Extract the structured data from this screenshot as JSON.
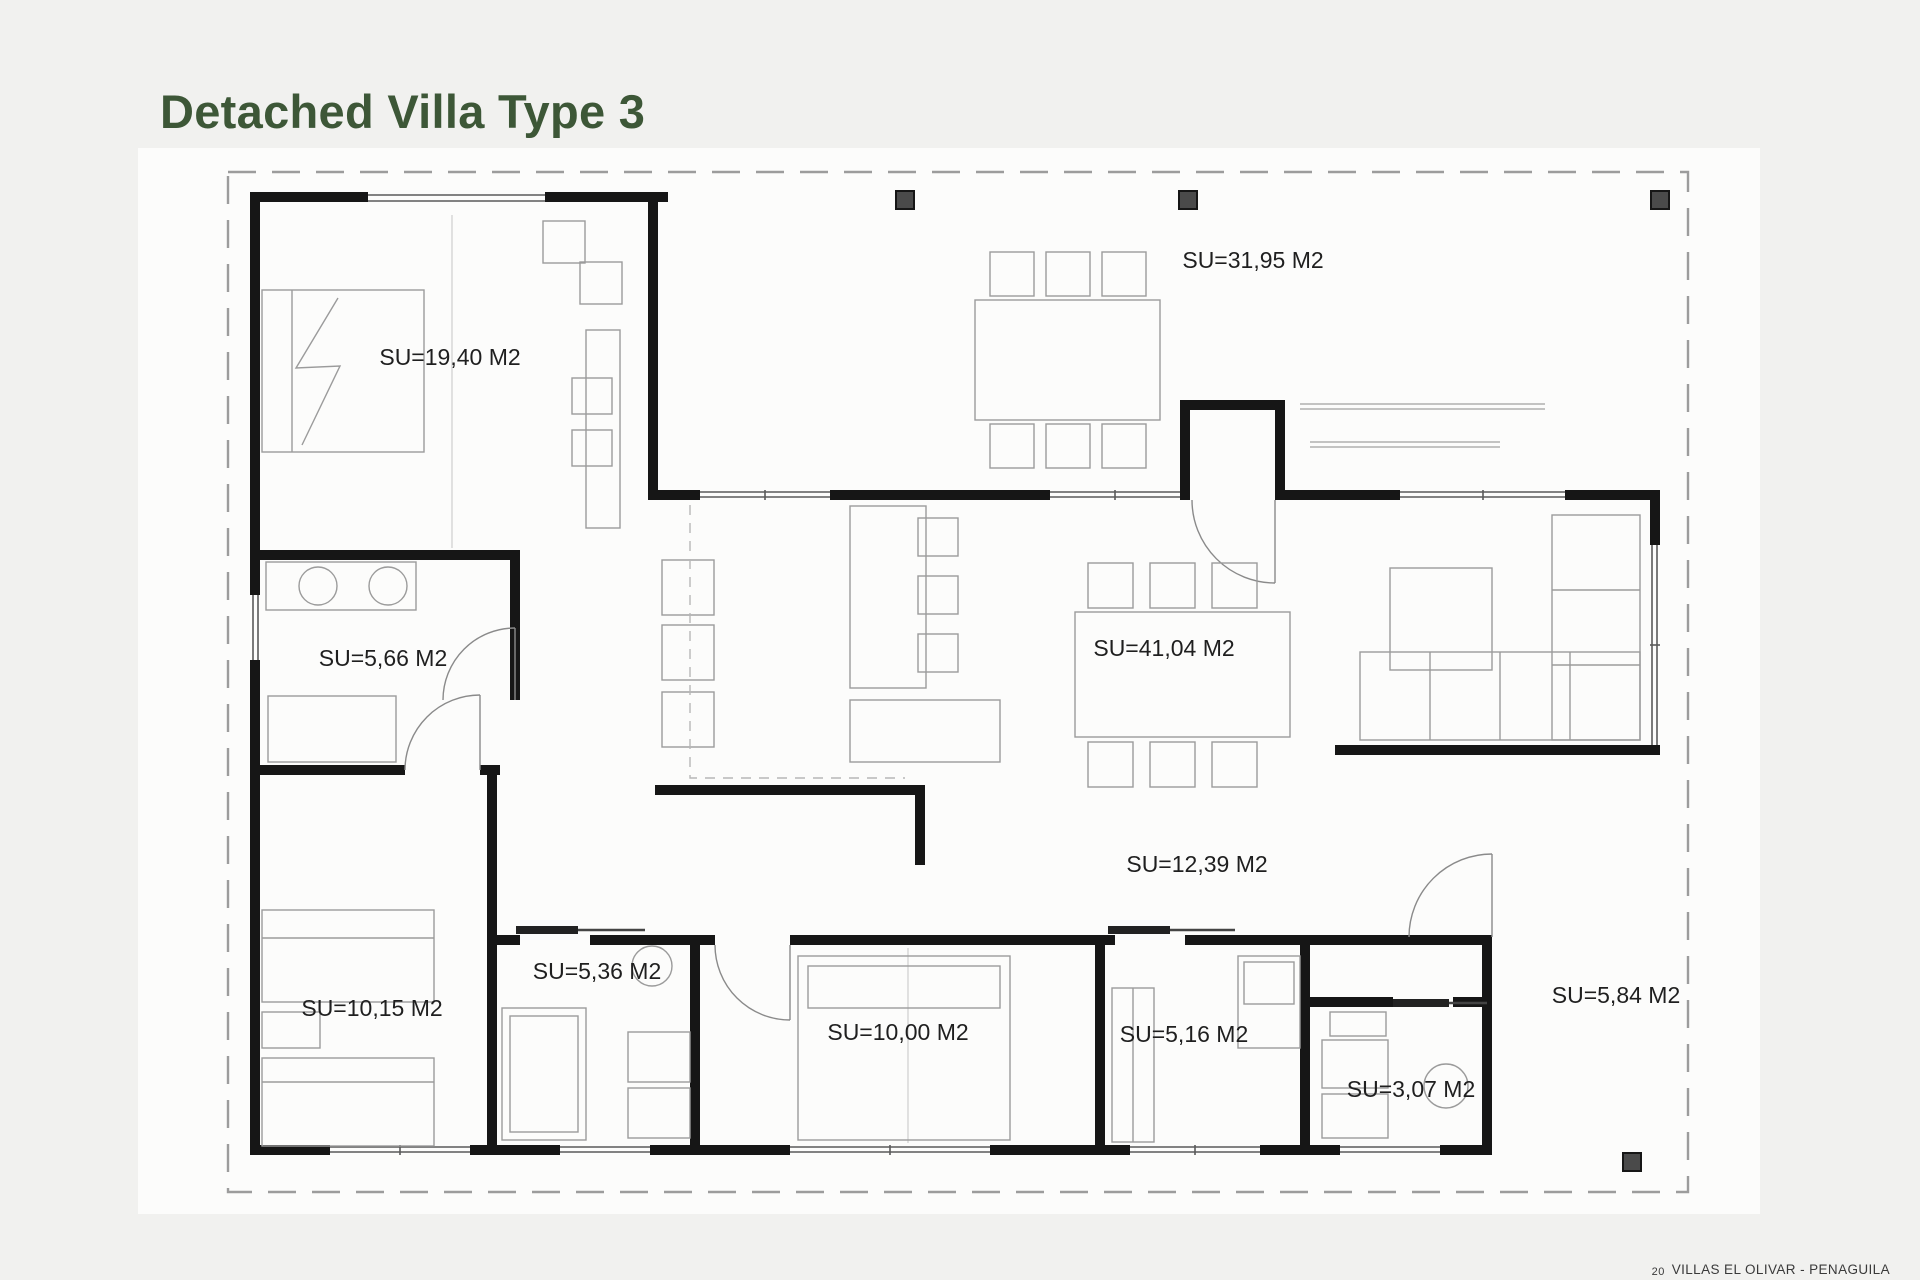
{
  "page": {
    "title": "Detached Villa Type 3",
    "title_color": "#3d5737",
    "background": "#f1f1ef",
    "footer": {
      "page_number": "20",
      "project_name": "VILLAS EL OLIVAR - PENAGUILA"
    }
  },
  "floor_plan": {
    "name": "Detached Villa Type 3 floor plan",
    "area_unit": "M2",
    "rooms": [
      {
        "id": "master-bedroom",
        "label": "SU=19,40 M2",
        "area_m2": "19,40"
      },
      {
        "id": "terrace",
        "label": "SU=31,95 M2",
        "area_m2": "31,95"
      },
      {
        "id": "ensuite-bathroom",
        "label": "SU=5,66 M2",
        "area_m2": "5,66"
      },
      {
        "id": "living-dining-kitchen",
        "label": "SU=41,04 M2",
        "area_m2": "41,04"
      },
      {
        "id": "hallway",
        "label": "SU=12,39 M2",
        "area_m2": "12,39"
      },
      {
        "id": "bedroom-2",
        "label": "SU=10,15 M2",
        "area_m2": "10,15"
      },
      {
        "id": "bathroom-2",
        "label": "SU=5,36 M2",
        "area_m2": "5,36"
      },
      {
        "id": "bedroom-3",
        "label": "SU=10,00 M2",
        "area_m2": "10,00"
      },
      {
        "id": "bathroom-3",
        "label": "SU=5,16 M2",
        "area_m2": "5,16"
      },
      {
        "id": "laundry-wc",
        "label": "SU=3,07 M2",
        "area_m2": "3,07"
      },
      {
        "id": "porch",
        "label": "SU=5,84 M2",
        "area_m2": "5,84"
      }
    ],
    "colors": {
      "walls": "#161616",
      "room_label": "#1f1f1f",
      "furniture_line": "#9b9b9b",
      "window_line": "#5a5a5a",
      "plot_boundary": "#9c9c9c",
      "pillar_fill": "#4a4a4a"
    }
  }
}
